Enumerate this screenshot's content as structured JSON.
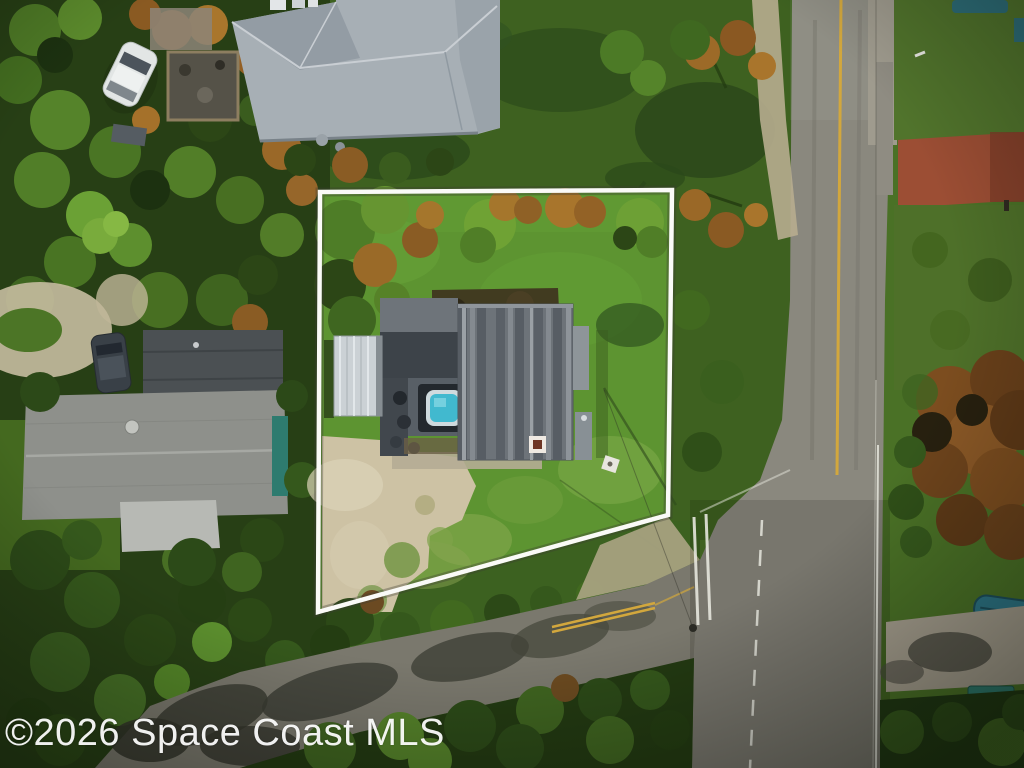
{
  "watermark": {
    "text": "©2026 Space Coast MLS"
  },
  "scene": {
    "type": "aerial-drone-photo",
    "subject": "residential lot outlined with white property boundary, single-story house with metal roof, shed, hot tub, sandy driveway, bordered by a vertical two-lane road on the right and a diagonal road at the bottom"
  },
  "colors": {
    "lawn": "#5d9431",
    "lawn_outside": "#3e6120",
    "veg_dark": "#273f15",
    "sand": "#cdc2a4",
    "asphalt": "#8a887e",
    "asphalt_dark": "#7a786d",
    "yellow_line": "#d2a73d",
    "white_line": "#e6e6dd",
    "boundary": "#fafaf7",
    "roof_neighbor": "#a7afb5",
    "roof_main": "#6d7379",
    "roof_flat": "#3d4349",
    "shed": "#cbd1d5",
    "hot_tub": "#41b9cf",
    "teal": "#2e7b6f",
    "brick": "#9c4e34",
    "boat": "#2d7687",
    "watermark": "#ffffff"
  }
}
